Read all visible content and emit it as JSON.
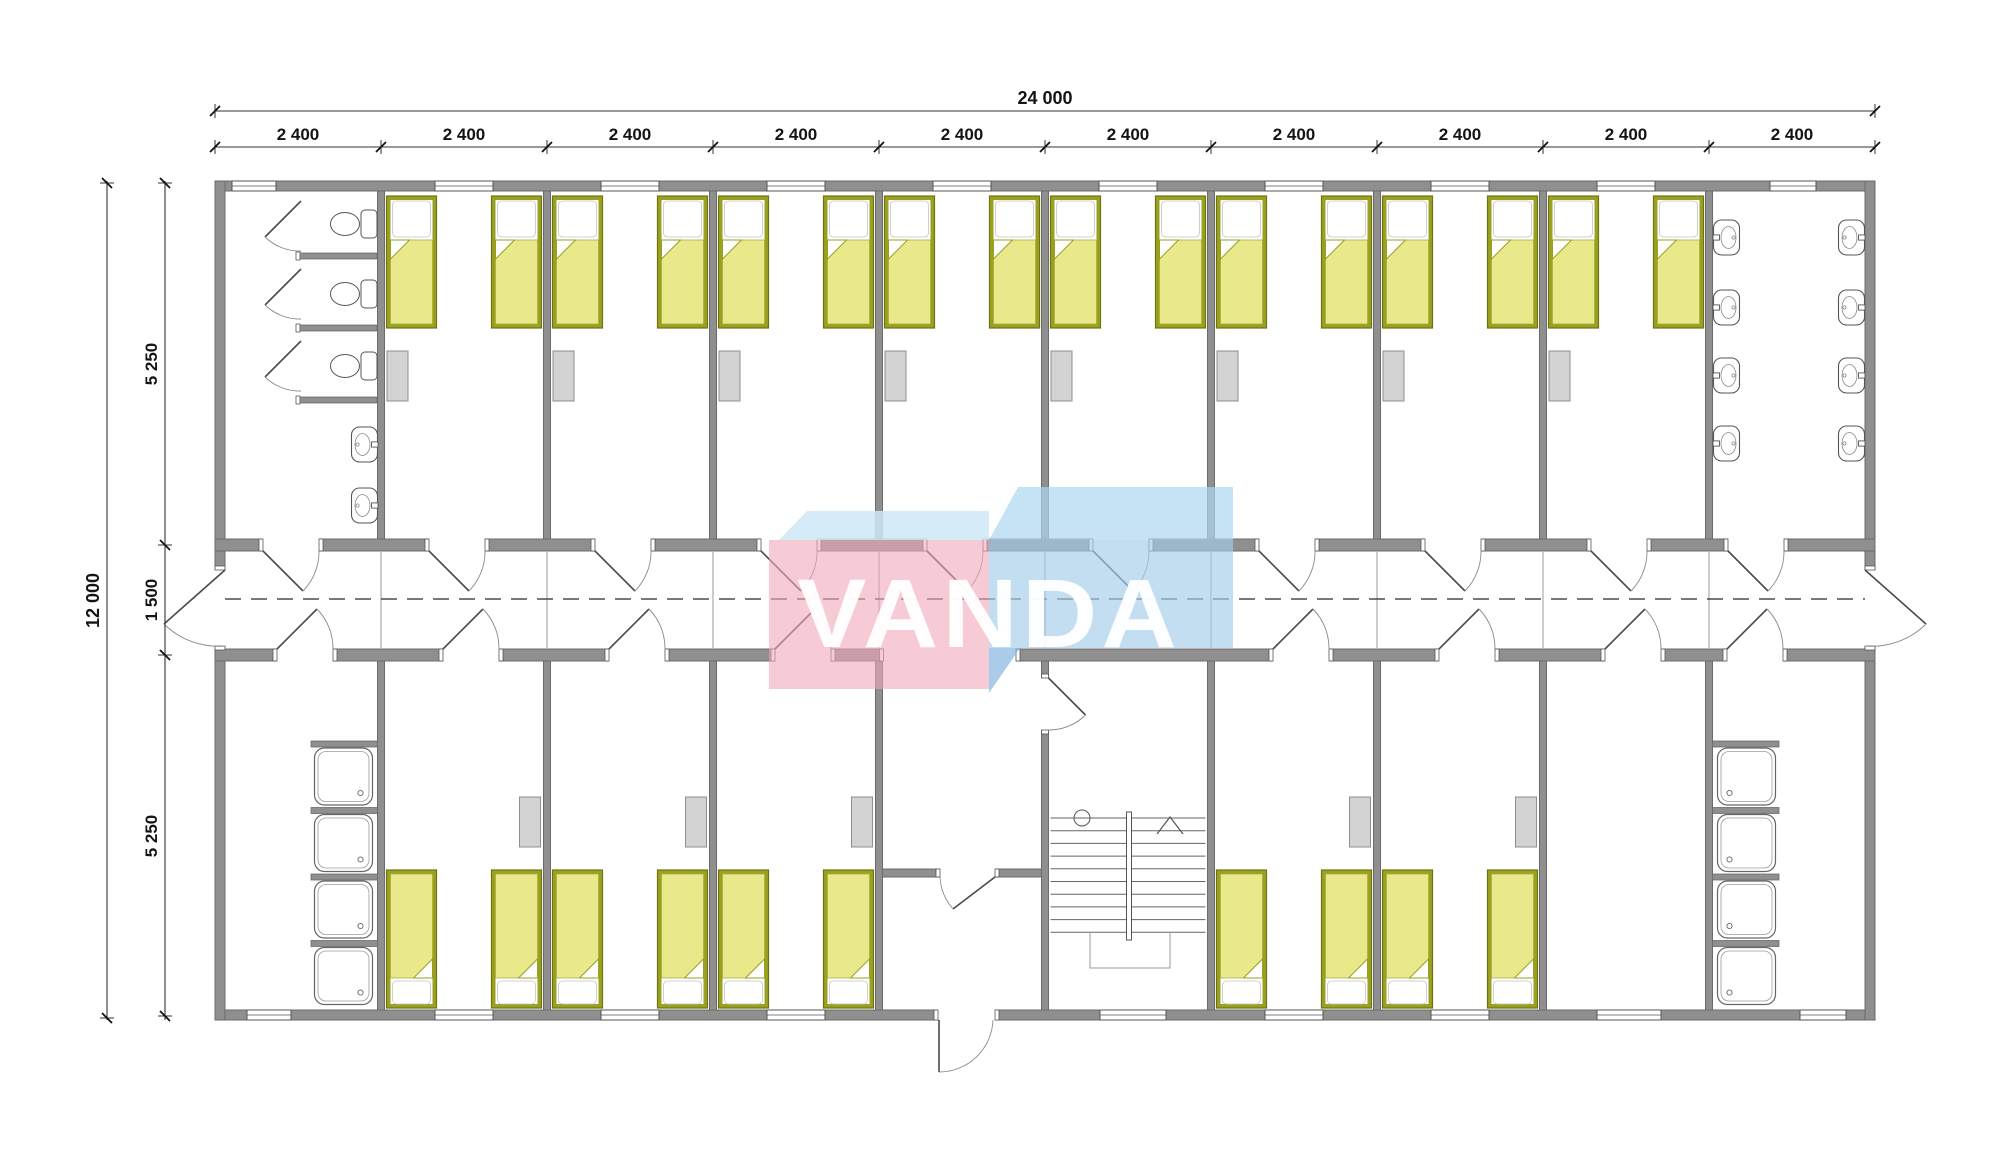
{
  "title": "Modular dormitory floor plan",
  "logo": {
    "text": "VANDA",
    "pink_face": "#f0a9bb",
    "pink_band": "#cfe7f7",
    "blue_top": "#aed7f2",
    "blue_face": "#a6cde9",
    "blue_dark": "#86b7de",
    "letters": "#ffffff"
  },
  "dimensions": {
    "top_total": "24 000",
    "top_bays": [
      "2 400",
      "2 400",
      "2 400",
      "2 400",
      "2 400",
      "2 400",
      "2 400",
      "2 400",
      "2 400",
      "2 400"
    ],
    "left_total": "12 000",
    "left_segments": [
      "5 250",
      "1 500",
      "5 250"
    ]
  },
  "plan": {
    "grid_mm": {
      "bay_width": 2400,
      "bays": 10,
      "total_width": 24000,
      "top_depth": 5250,
      "corridor": 1500,
      "bottom_depth": 5250
    },
    "top_rooms": [
      {
        "bay": 1,
        "type": "sanitary-room",
        "toilets": 3,
        "sinks": 2
      },
      {
        "bay": 2,
        "type": "bedroom",
        "beds": 2,
        "wardrobes": 1
      },
      {
        "bay": 3,
        "type": "bedroom",
        "beds": 2,
        "wardrobes": 1
      },
      {
        "bay": 4,
        "type": "bedroom",
        "beds": 2,
        "wardrobes": 1
      },
      {
        "bay": 5,
        "type": "bedroom",
        "beds": 2,
        "wardrobes": 1
      },
      {
        "bay": 6,
        "type": "bedroom",
        "beds": 2,
        "wardrobes": 1
      },
      {
        "bay": 7,
        "type": "bedroom",
        "beds": 2,
        "wardrobes": 1
      },
      {
        "bay": 8,
        "type": "bedroom",
        "beds": 2,
        "wardrobes": 1
      },
      {
        "bay": 9,
        "type": "bedroom",
        "beds": 2,
        "wardrobes": 1
      },
      {
        "bay": 10,
        "type": "washroom",
        "sinks": 8
      }
    ],
    "bottom_rooms": [
      {
        "bay": 1,
        "type": "shower-room",
        "showers": 4
      },
      {
        "bay": 2,
        "type": "bedroom",
        "beds": 2,
        "wardrobes": 1
      },
      {
        "bay": 3,
        "type": "bedroom",
        "beds": 2,
        "wardrobes": 1
      },
      {
        "bay": 4,
        "type": "bedroom",
        "beds": 2,
        "wardrobes": 1
      },
      {
        "bay": 5,
        "type": "entrance-lobby"
      },
      {
        "bay": 6,
        "type": "staircase",
        "treads": 10
      },
      {
        "bay": 7,
        "type": "bedroom",
        "beds": 2,
        "wardrobes": 1
      },
      {
        "bay": 8,
        "type": "bedroom",
        "beds": 2,
        "wardrobes": 1
      },
      {
        "bay": 9,
        "type": "drying-room"
      },
      {
        "bay": 10,
        "type": "shower-room",
        "showers": 4
      }
    ]
  },
  "colors": {
    "wall": "#8f8f8f",
    "wall_edge": "#6b6b6b",
    "line": "#4a4a4a",
    "arc": "#8a8a8a",
    "window_edge": "#555555",
    "bed_frame": "#9aa01f",
    "bed_frame_edge": "#6f7410",
    "blanket": "#e9e98c",
    "blanket_edge": "#aab13e",
    "pillow": "#ffffff",
    "pillow_edge": "#c4c4c4",
    "locker": "#d2d2d2",
    "locker_edge": "#8f8f8f",
    "fixture_edge": "#565656",
    "joint": "#b5b5b5",
    "dash": "#4a4a4a",
    "dim": "#141414"
  }
}
